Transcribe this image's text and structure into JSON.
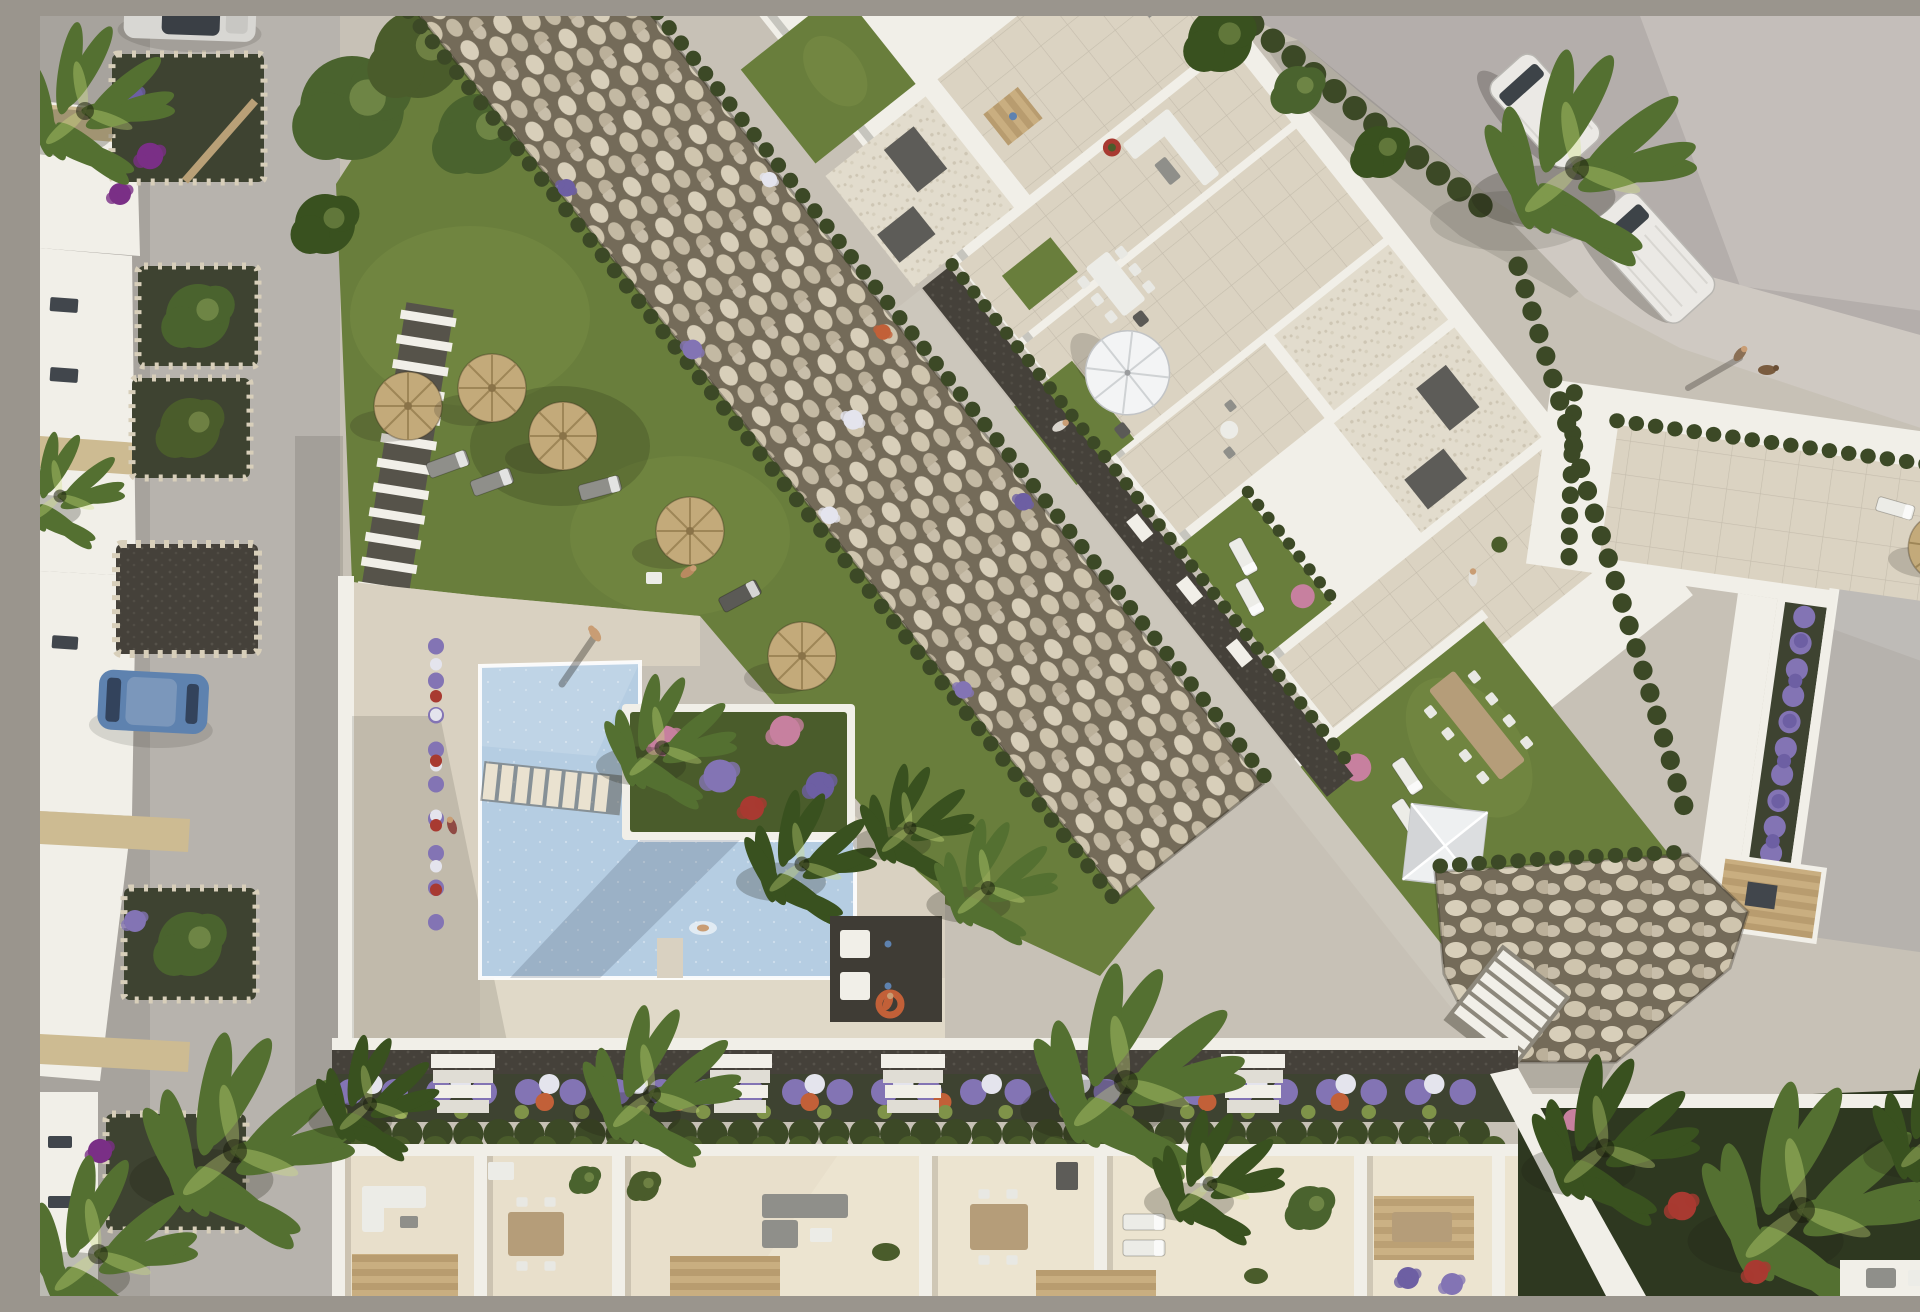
{
  "scene": {
    "title": "Aerial 3D render of a Mediterranean residential complex with communal pool",
    "type": "photorealistic architectural visualization, top-down aerial view",
    "lighting": "low afternoon sun from the upper right; long soft shadows fall toward the lower left",
    "description": "Top-down render of a new-build white apartment complex. A diagonal band of flat-roofed blocks with rooftop terraces, white-gravel roofs, private lawns and tiled patios crosses the centre. A wide rock-armour embankment edged with clipped hedges and flowering shrubs separates it from a communal garden with straw parasols, sun loungers, a stepping-stone path and an L-shaped pool with a planted island on a cream sun deck. A residential street with stone planters and parked cars runs down the left, an asphalt road with two white vans and a tall palm crosses the top right, a row of private ground-floor terraces with outdoor furniture lines the bottom, and a neighbouring villa with a grey roof, cypress hedges, a lavender border and a timber deck sits at the right edge."
  },
  "palette": {
    "pavement": "#c7c1b6",
    "street": "#b7b3ad",
    "street_shade": "#a19d96",
    "deck": "#d9d1c1",
    "deck_light": "#eae2d0",
    "road": "#b4aeab",
    "road_light": "#cbc5c1",
    "drive": "#cfc9c2",
    "white_wall": "#f1efe8",
    "wall_shade": "#c8c5bd",
    "tile": "#dbd3c2",
    "grass": "#697e3c",
    "grass_light": "#7f9349",
    "grass_dark": "#4a5c2b",
    "hedge": "#3c4926",
    "tree": "#4a632e",
    "palm": "#547031",
    "palm_dark": "#39511f",
    "water": "#b5cde2",
    "water_light": "#d2e3f2",
    "water_dark": "#97b5d0",
    "stone_base": "#746b59",
    "stone_light": "#d8cfba",
    "stone_mid": "#c3b9a3",
    "gravel_white": "#e2dccd",
    "gravel_dot": "#cec6b4",
    "gravel_dark": "#45413a",
    "soil": "#3e4331",
    "straw": "#c3aa7a",
    "straw_dark": "#9e8657",
    "umbrella_white": "#f3f4f5",
    "furn_white": "#ecece7",
    "furn_gray": "#8f8f8a",
    "furn_dark": "#5b5a56",
    "wood": "#b59d79",
    "box_dark": "#5d5c58",
    "flower_purple": "#8374b4",
    "flower_violet": "#6d5fa3",
    "flower_white": "#e4e4ed",
    "flower_orange": "#c26038",
    "flower_pink": "#c7809f",
    "flower_red": "#a83a31",
    "van_white": "#ebe9e5",
    "car_blue": "#5e82af",
    "car_silver": "#d8d7d3",
    "skin": "#c99d74"
  },
  "inventory": {
    "pool": {
      "shape": "L-shaped",
      "water": "light blue",
      "features": [
        "stepping-stair crossing the narrow arm",
        "planted flower island with two palms",
        "swim platform",
        "swimmer",
        "poolside shower pad"
      ]
    },
    "communal_garden": {
      "straw_parasols": 5,
      "sun_lounger_groups": 4,
      "stepping_stone_path": 1,
      "seating_nook": 1
    },
    "apartment_band": {
      "orientation_deg": 51,
      "rooftop_lawns": 5,
      "white_gravel_roofs": 4,
      "tiled_patios": 5,
      "roof_access_boxes": 7,
      "white_patio_umbrella": 1,
      "dining_sets": 3,
      "lounge_sofas": 2,
      "canopy_tent": 1
    },
    "embankment": {
      "type": "rock armour / riprap",
      "hedge_rows": 2,
      "flower_clusters": "purple, white and orange shrubs"
    },
    "street_left": {
      "stone_planters": 6,
      "parked_cars": [
        "blue hatchback",
        "silver car at top edge"
      ]
    },
    "road_top_right": {
      "white_vans": 2,
      "large_palm": 1,
      "pedestrian_with_dog": 1
    },
    "terrace_row_bottom": {
      "units": 6,
      "flower_border": "purple/white/orange bedding over clipped hedge",
      "stair_flights": 4,
      "pergolas": 3
    },
    "villa_right": {
      "grey_roof": 1,
      "lavender_border": 1,
      "timber_deck": 1,
      "cypress_hedges": 3,
      "straw_parasol": 1
    },
    "people": 8,
    "dogs": 1,
    "palm_trees": 16,
    "stair_flights_total": 5,
    "lifebuoy_orange": 1
  }
}
